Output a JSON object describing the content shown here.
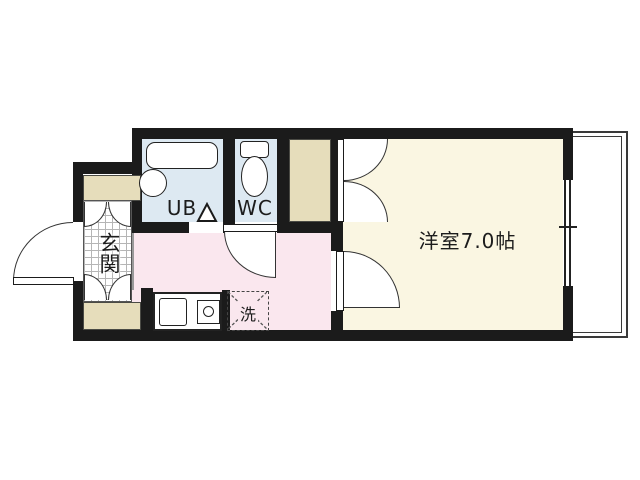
{
  "floorplan": {
    "labels": {
      "unit_bath": "UB",
      "toilet": "WC",
      "entrance": "玄関",
      "washer": "洗",
      "main_room": "洋室7.0帖"
    },
    "colors": {
      "wall": "#1b1b1b",
      "bath_floor": "#dde9f2",
      "kitchen_floor": "#fae7ee",
      "room_floor": "#faf6e2",
      "cabinet_fill": "#e6ddbb",
      "background": "#ffffff"
    }
  }
}
